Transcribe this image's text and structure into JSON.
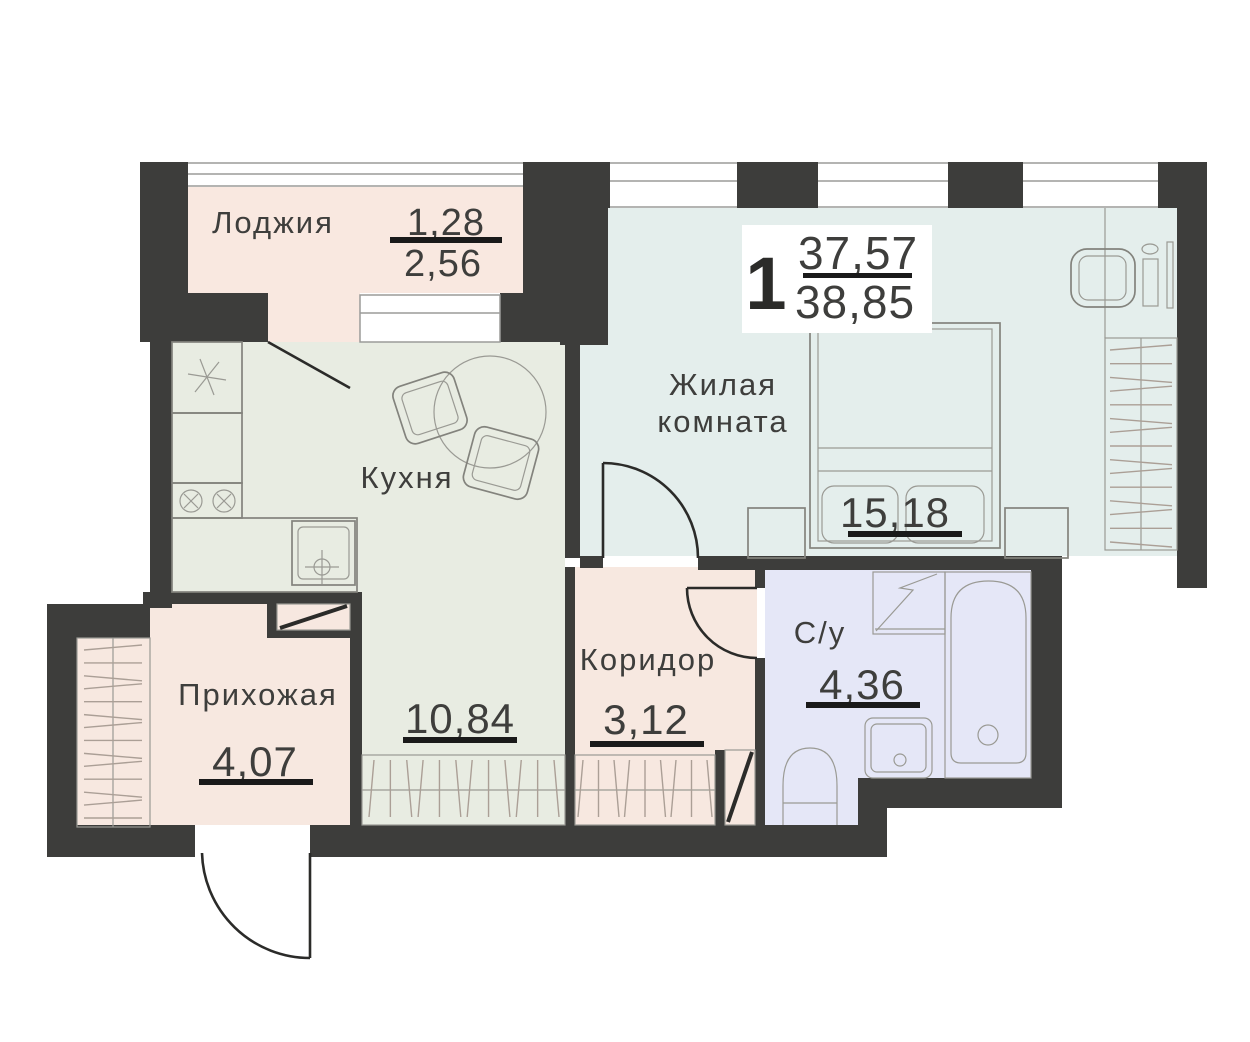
{
  "summary": {
    "rooms_count": "1",
    "living_area": "37,57",
    "total_area": "38,85"
  },
  "rooms": {
    "loggia": {
      "label": "Лоджия",
      "area_coef": "1,28",
      "area_full": "2,56"
    },
    "living": {
      "label_line1": "Жилая",
      "label_line2": "комната",
      "area": "15,18"
    },
    "kitchen": {
      "label": "Кухня",
      "area": "10,84"
    },
    "corridor": {
      "label": "Коридор",
      "area": "3,12"
    },
    "hallway": {
      "label": "Прихожая",
      "area": "4,07"
    },
    "bathroom": {
      "label": "С/у",
      "area": "4,36"
    }
  },
  "colors": {
    "wall": "#3d3d3b",
    "loggia_floor": "#f9e8e0",
    "living_floor": "#e4eeec",
    "kitchen_floor": "#e8ece2",
    "corridor_floor": "#f7e8e0",
    "hallway_floor": "#f7e8e0",
    "bathroom_floor": "#e5e7f7",
    "underline": "#1a1a1a",
    "text": "#3e3e3c"
  }
}
